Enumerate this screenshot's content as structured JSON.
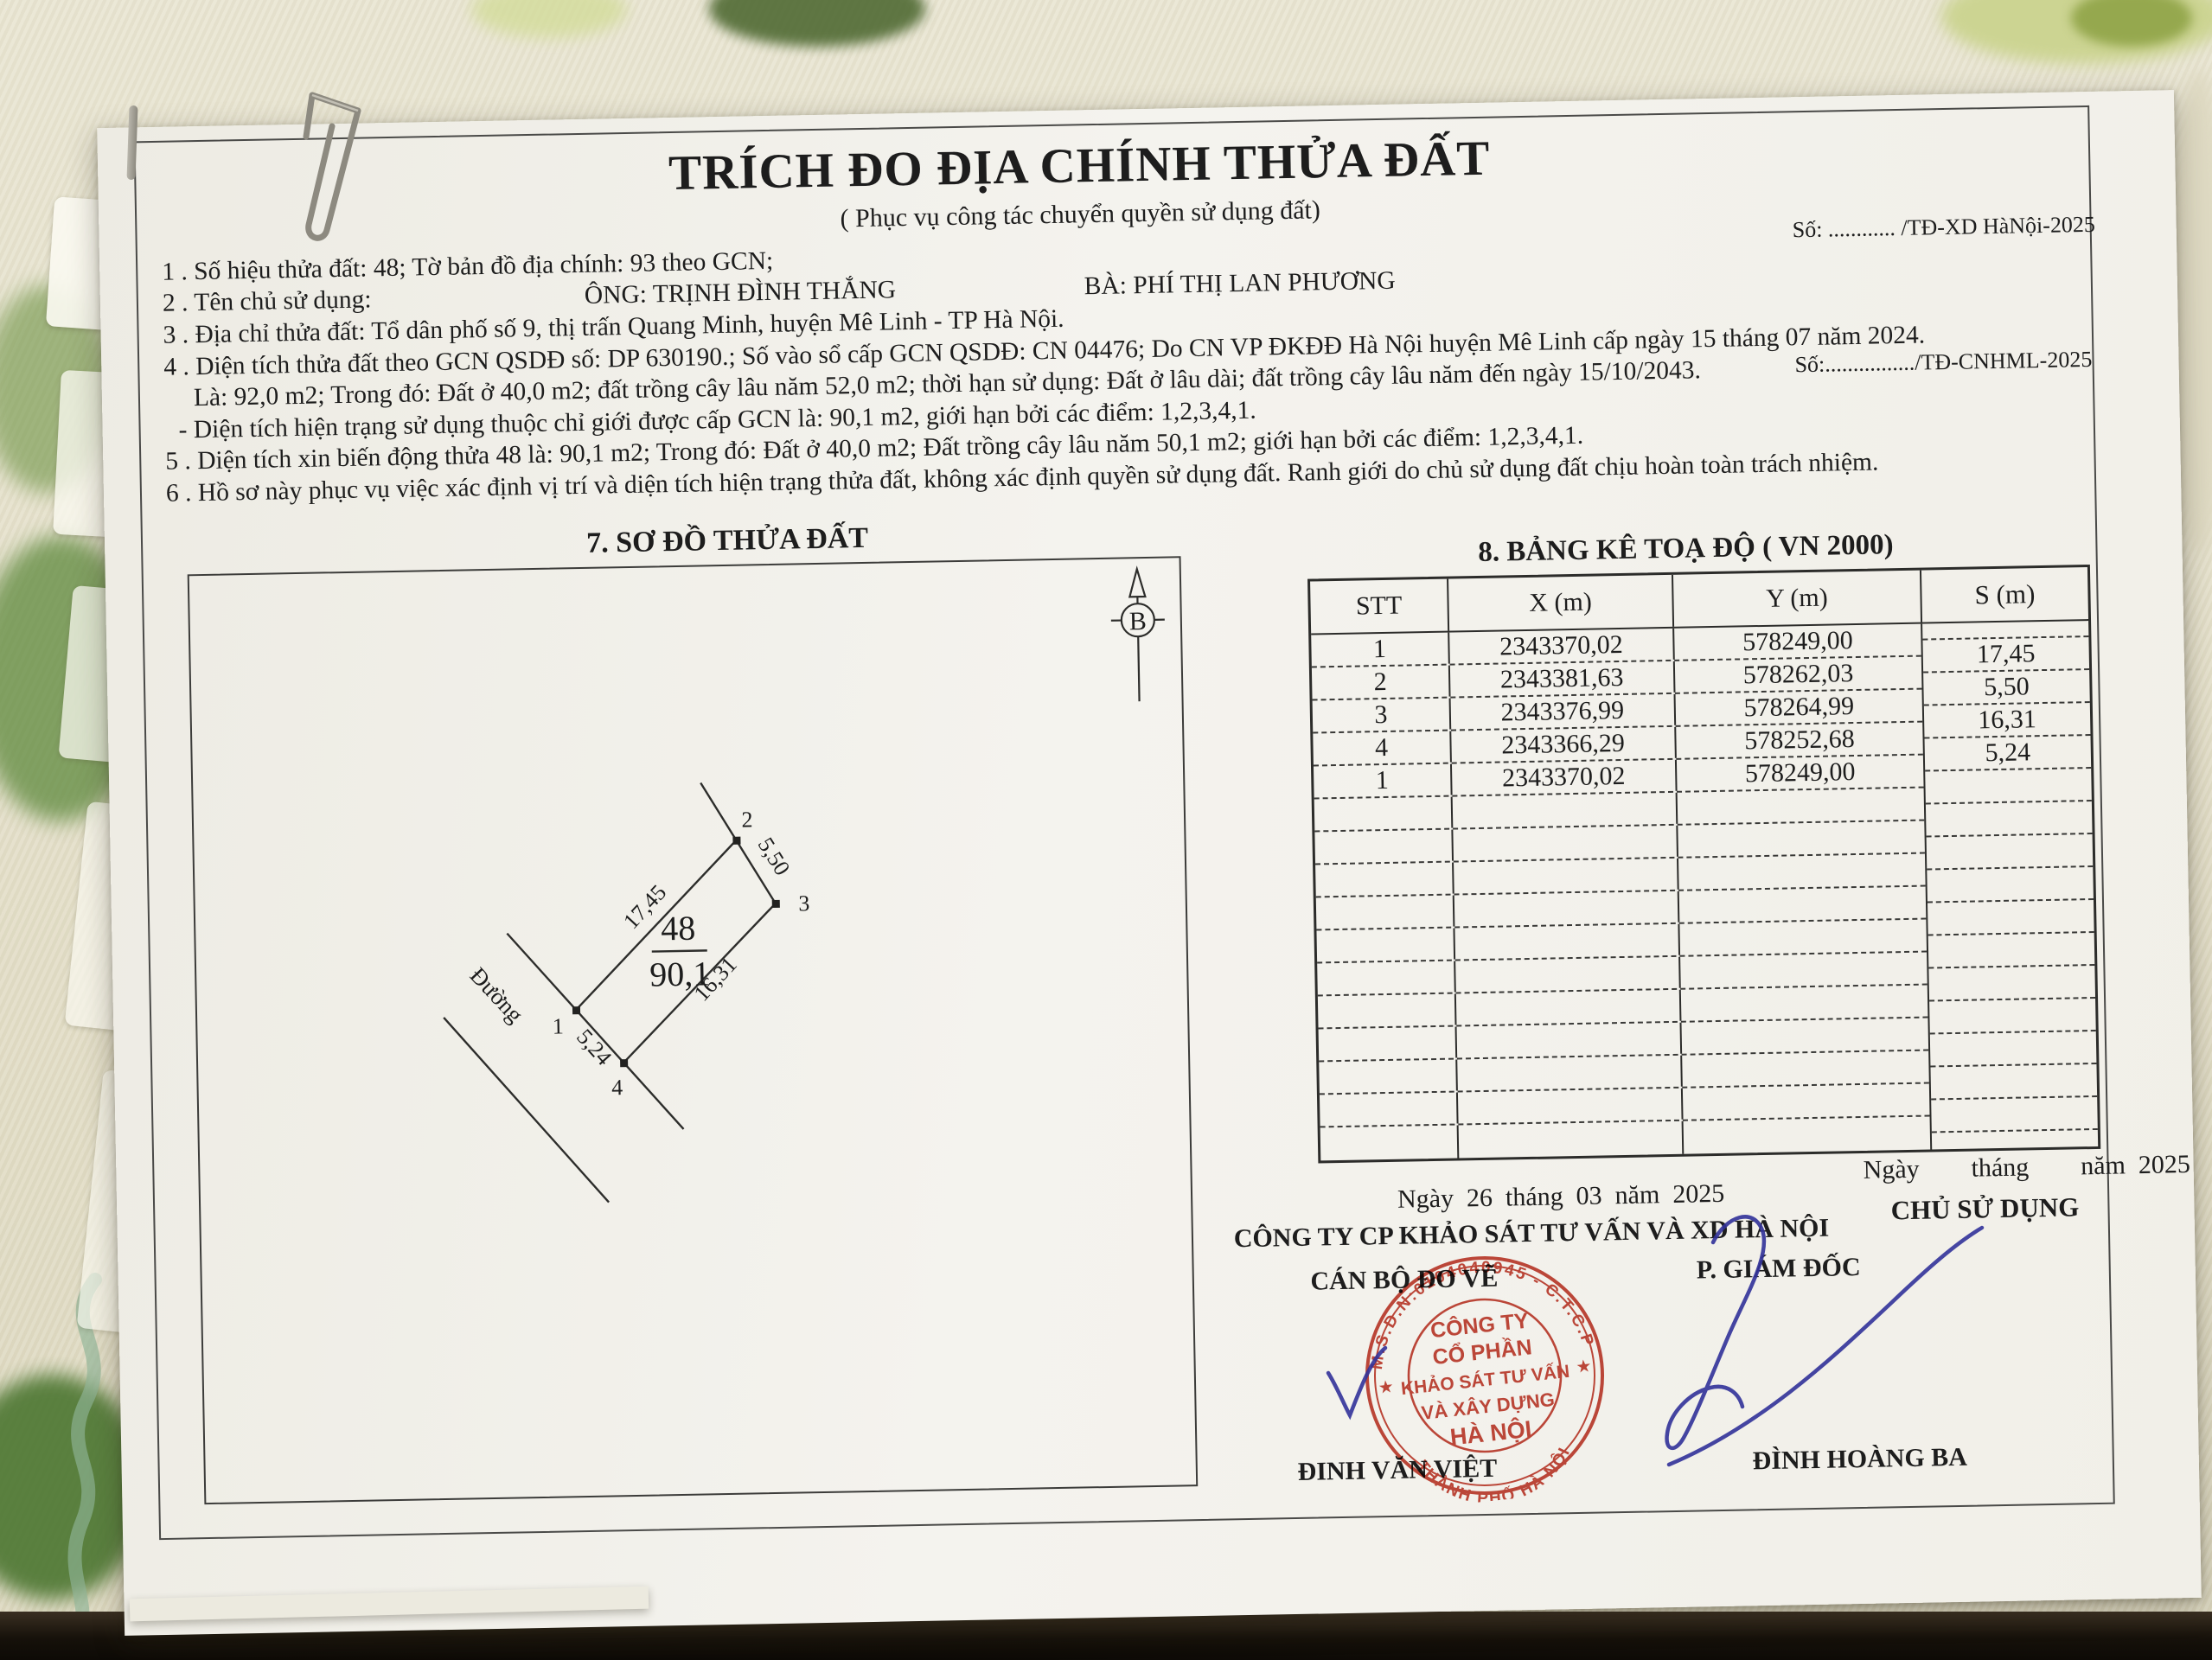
{
  "refs": {
    "so1": "Số: ............ /TĐ-XD HàNội-2025",
    "so2": "Số:................/TĐ-CNHML-2025"
  },
  "header": {
    "title": "TRÍCH ĐO ĐỊA CHÍNH THỬA ĐẤT",
    "subtitle": "( Phục vụ công tác chuyển quyền sử dụng đất)"
  },
  "info": {
    "l1": "1 . Số hiệu thửa đất: 48; Tờ bản đồ địa chính: 93 theo GCN;",
    "l2_label": "2 . Tên chủ sử dụng:",
    "l2_ong": "ÔNG: TRỊNH ĐÌNH THẮNG",
    "l2_ba": "BÀ: PHÍ THỊ LAN PHƯƠNG",
    "l3": "3 . Địa chỉ thửa đất: Tổ dân phố số 9, thị trấn Quang Minh, huyện Mê Linh - TP Hà Nội.",
    "l4": "4 . Diện tích thửa đất theo GCN QSDĐ số: DP 630190.; Số vào sổ cấp GCN QSDĐ: CN 04476; Do CN VP ĐKĐĐ Hà Nội huyện Mê Linh cấp ngày 15 tháng 07 năm 2024.",
    "l4b": "Là: 92,0 m2; Trong đó: Đất ở 40,0 m2; đất trồng cây lâu năm 52,0 m2; thời hạn sử dụng: Đất ở lâu dài; đất trồng cây lâu năm đến ngày 15/10/2043.",
    "l4c": "- Diện tích hiện trạng sử dụng thuộc chỉ giới được cấp GCN là: 90,1 m2, giới hạn bởi các điểm: 1,2,3,4,1.",
    "l5": "5 . Diện tích xin biến động thửa 48 là: 90,1 m2; Trong đó: Đất ở 40,0 m2; Đất trồng cây lâu năm 50,1 m2; giới hạn bởi các điểm: 1,2,3,4,1.",
    "l6": "6 . Hồ sơ này phục vụ việc xác định vị trí và diện tích hiện trạng thửa đất, không xác định quyền sử dụng đất. Ranh giới do chủ sử dụng đất chịu hoàn toàn trách nhiệm."
  },
  "plot": {
    "heading": "7. SƠ ĐỒ THỬA ĐẤT",
    "north_label": "B",
    "road_label": "Đường",
    "parcel_no": "48",
    "parcel_area": "90,1",
    "v1": "1",
    "v2": "2",
    "v3": "3",
    "v4": "4",
    "len12": "17,45",
    "len23": "5,50",
    "len34": "16,31",
    "len41": "5,24"
  },
  "table": {
    "heading": "8. BẢNG KÊ TOẠ ĐỘ ( VN 2000)",
    "col_stt": "STT",
    "col_x": "X (m)",
    "col_y": "Y (m)",
    "col_s": "S (m)",
    "rows": [
      {
        "stt": "1",
        "x": "2343370,02",
        "y": "578249,00"
      },
      {
        "stt": "2",
        "x": "2343381,63",
        "y": "578262,03"
      },
      {
        "stt": "3",
        "x": "2343376,99",
        "y": "578264,99"
      },
      {
        "stt": "4",
        "x": "2343366,29",
        "y": "578252,68"
      },
      {
        "stt": "1",
        "x": "2343370,02",
        "y": "578249,00"
      }
    ],
    "s_values": [
      "17,45",
      "5,50",
      "16,31",
      "5,24"
    ]
  },
  "sign": {
    "date_left": "Ngày  26  tháng  03  năm  2025",
    "company": "CÔNG TY CP KHẢO SÁT TƯ VẤN VÀ XD HÀ NỘI",
    "surveyor_role": "CÁN BỘ ĐO VẼ",
    "director_role": "P. GIÁM ĐỐC",
    "date_right": "Ngày        tháng        năm  2025",
    "owner_role": "CHỦ SỬ DỤNG",
    "surveyor_name": "ĐINH VĂN VIỆT",
    "director_name": "ĐÌNH HOÀNG BA"
  },
  "stamp": {
    "ring_top": "M.S.D.N:0104040945 - C.T.C.P",
    "ring_bottom": "THÀNH PHỐ HÀ NỘI",
    "star": "★",
    "l1": "CÔNG TY",
    "l2": "CỔ PHẦN",
    "l3": "KHẢO SÁT TƯ VẤN",
    "l4": "VÀ XÂY DỰNG",
    "l5": "HÀ NỘI",
    "color": "#bf3a2b"
  },
  "colors": {
    "ink": "#1d1d1d",
    "stamp_red": "#bf3a2b",
    "signature_blue": "#32329a",
    "fabric": "#e3dfca"
  }
}
